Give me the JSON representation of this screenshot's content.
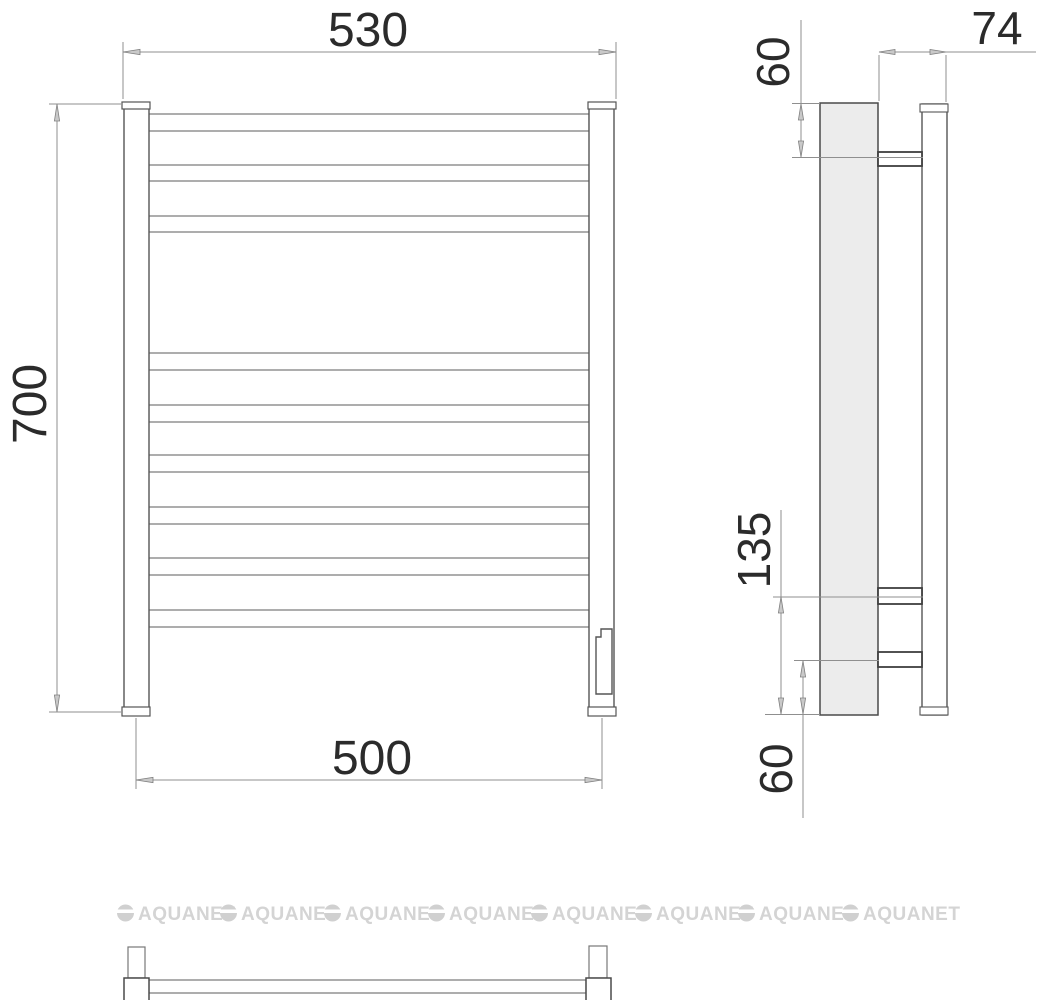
{
  "front_view": {
    "width_top_mm": "530",
    "height_mm": "700",
    "width_bottom_mm": "500",
    "rung_count": 9
  },
  "side_view": {
    "depth_mm": "74",
    "top_offset_mm": "60",
    "middle_span_mm": "135",
    "bottom_offset_mm": "60"
  },
  "watermark": {
    "text": "AQUANET",
    "count": 8
  },
  "colors": {
    "object_line": "#555555",
    "dimension_line": "#8f8f8f",
    "dimension_text": "#2b2b2b",
    "plate_fill": "#ececec",
    "watermark": "#d4d4d4",
    "background": "#ffffff"
  }
}
